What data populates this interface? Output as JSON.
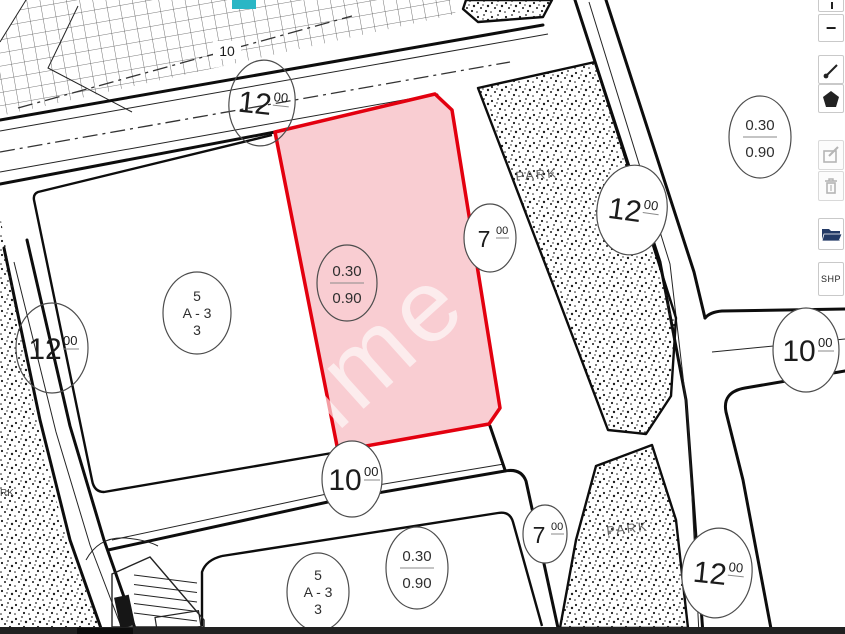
{
  "map": {
    "road_width_labels": [
      {
        "id": "road-top",
        "main": "12",
        "decimals": "00"
      },
      {
        "id": "road-left",
        "main": "12",
        "decimals": "00"
      },
      {
        "id": "road-middle",
        "main": "7",
        "decimals": "00"
      },
      {
        "id": "road-right",
        "main": "12",
        "decimals": "00"
      },
      {
        "id": "road-east",
        "main": "10",
        "decimals": "00"
      },
      {
        "id": "road-bottom",
        "main": "10",
        "decimals": "00"
      },
      {
        "id": "road-bottom-7",
        "main": "7",
        "decimals": "00"
      },
      {
        "id": "road-bottom-right",
        "main": "12",
        "decimals": "00"
      }
    ],
    "ratio_labels": [
      {
        "id": "ratio-upper-right",
        "numerator": "0.30",
        "denominator": "0.90"
      },
      {
        "id": "ratio-selected-parcel",
        "numerator": "0.30",
        "denominator": "0.90"
      },
      {
        "id": "ratio-lower-block",
        "numerator": "0.30",
        "denominator": "0.90"
      }
    ],
    "block_labels": [
      {
        "id": "block-left",
        "line1": "5",
        "line2": "A - 3",
        "line3": "3"
      },
      {
        "id": "block-lower",
        "line1": "5",
        "line2": "A - 3",
        "line3": "3"
      }
    ],
    "park_labels": [
      {
        "id": "park-upper",
        "text": "PARK"
      },
      {
        "id": "park-lower",
        "text": "PARK"
      },
      {
        "id": "park-left-partial",
        "text": "RK"
      }
    ],
    "hatch_area_label": "10",
    "watermark_text": "rime",
    "colors": {
      "parcel_fill": "#f9cdd2",
      "parcel_stroke": "#e3000f",
      "teal_marker": "#2ab6c5",
      "folder_icon": "#233a66",
      "bottom_bar": "#212121"
    }
  },
  "toolbar": {
    "minus_label": "−",
    "shp_label": "SHP"
  }
}
